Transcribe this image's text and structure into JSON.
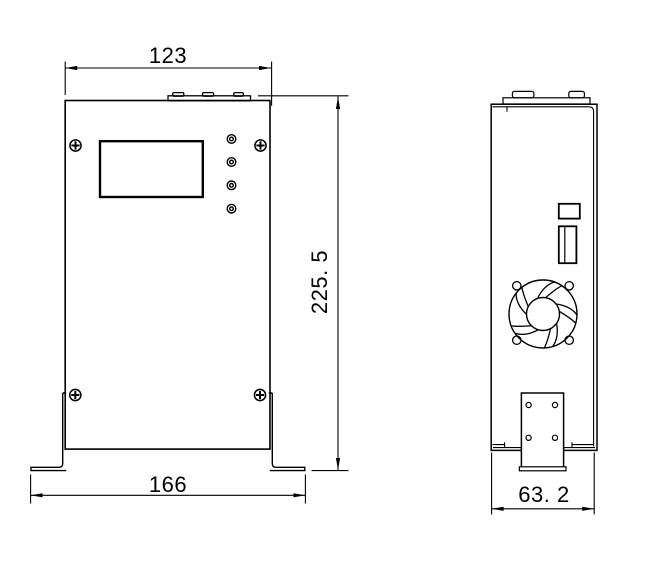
{
  "colors": {
    "background": "#ffffff",
    "line": "#000000"
  },
  "dimensions": {
    "front_top_width": "123",
    "front_height": "225. 5",
    "front_bottom_width": "166",
    "side_depth": "63. 2"
  }
}
